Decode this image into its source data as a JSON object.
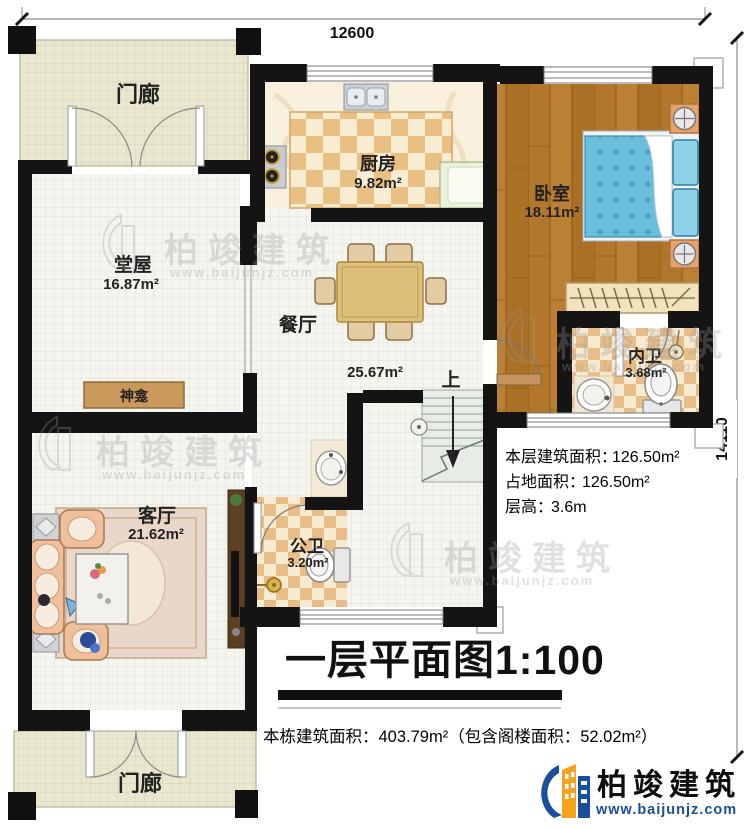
{
  "plan": {
    "title": "一层平面图1:100",
    "footer_note": "本栋建筑面积：403.79m²（包含阁楼面积：52.02m²）",
    "dims": {
      "top": "12600",
      "right": "14110"
    },
    "stats": [
      {
        "label": "本层建筑面积：",
        "value": "126.50m²"
      },
      {
        "label": "占地面积：",
        "value": "126.50m²"
      },
      {
        "label": "层高：",
        "value": "3.6m"
      }
    ],
    "rooms": {
      "porch_top": {
        "name": "门廊"
      },
      "porch_bottom": {
        "name": "门廊"
      },
      "kitchen": {
        "name": "厨房",
        "area": "9.82m²"
      },
      "bedroom": {
        "name": "卧室",
        "area": "18.11m²"
      },
      "hall": {
        "name": "堂屋",
        "area": "16.87m²"
      },
      "dining": {
        "name": "餐厅",
        "area": "25.67m²"
      },
      "living": {
        "name": "客厅",
        "area": "21.62m²"
      },
      "inner_bath": {
        "name": "内卫",
        "area": "3.68m²"
      },
      "public_bath": {
        "name": "公卫",
        "area": "3.20m²"
      },
      "shrine": {
        "name": "神龛"
      },
      "stairs": {
        "direction": "上"
      }
    },
    "colors": {
      "wall": "#141414",
      "wood_floor": "#b3772c",
      "bed": "#6abfdc",
      "porch": "#eae7d1",
      "checker": "#e9bf82",
      "brand_blue": "#1b4f9c",
      "brand_yellow": "#f6a21c"
    }
  },
  "brand": {
    "name": "柏竣建筑",
    "website": "www.baijunjz.com"
  },
  "watermark": {
    "name": "柏竣建筑",
    "website": "www.baijunjz.com"
  }
}
